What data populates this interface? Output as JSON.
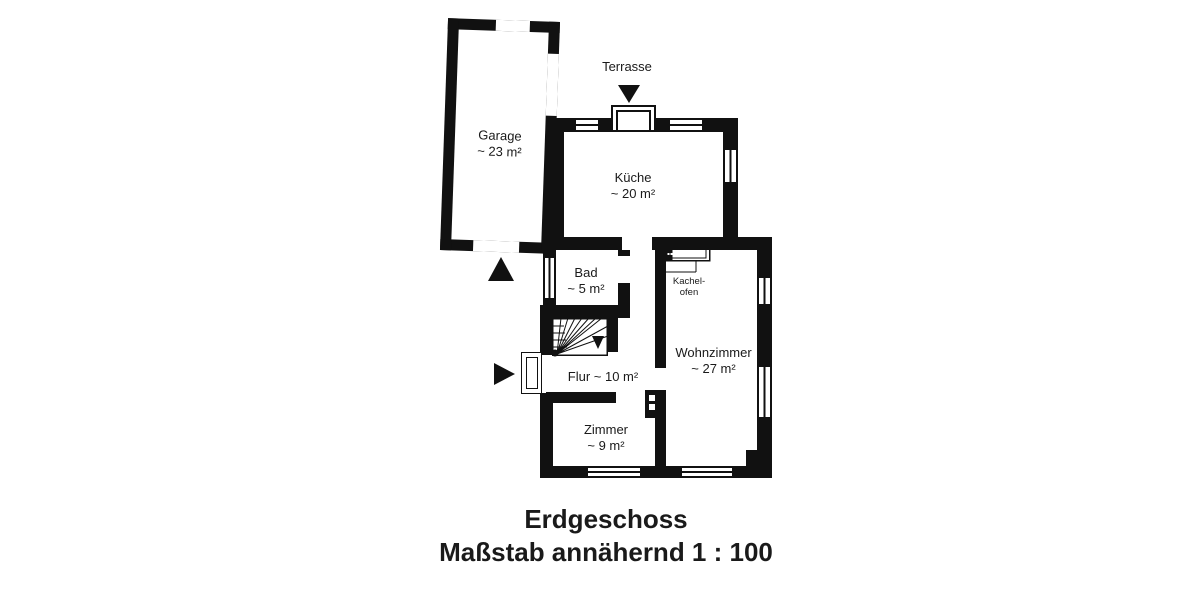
{
  "title": {
    "floor": "Erdgeschoss",
    "scale": "Maßstab annähernd 1 : 100"
  },
  "annotations": {
    "terrasse": "Terrasse"
  },
  "rooms": {
    "garage": {
      "name": "Garage",
      "area": "~ 23 m²"
    },
    "kueche": {
      "name": "Küche",
      "area": "~ 20 m²"
    },
    "bad": {
      "name": "Bad",
      "area": "~ 5 m²"
    },
    "flur": {
      "label": "Flur ~ 10 m²"
    },
    "zimmer": {
      "name": "Zimmer",
      "area": "~ 9 m²"
    },
    "wohnzimmer": {
      "name": "Wohnzimmer",
      "area": "~ 27 m²"
    },
    "kachelofen": {
      "line1": "Kachel-",
      "line2": "ofen"
    }
  },
  "colors": {
    "wall": "#111111",
    "background": "#ffffff",
    "text": "#1a1a1a"
  }
}
